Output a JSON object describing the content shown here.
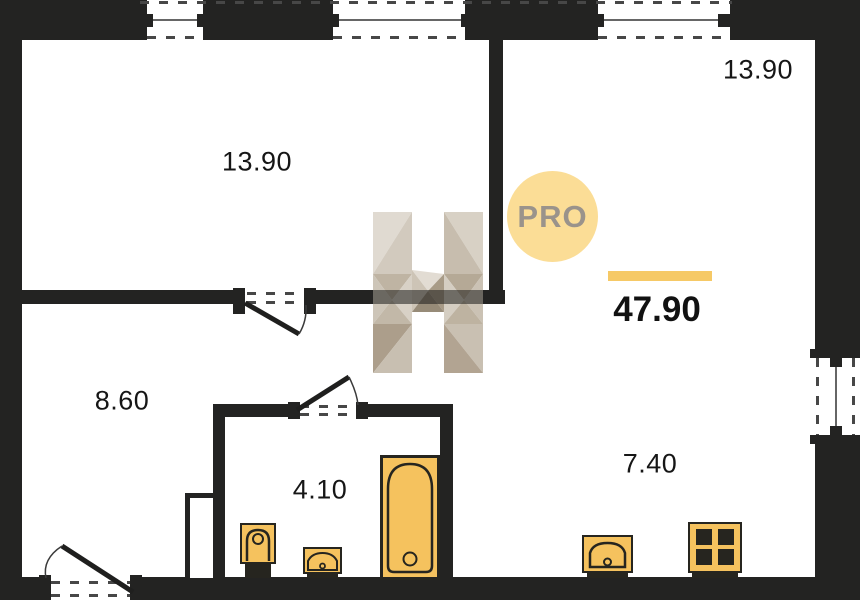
{
  "badge": {
    "label": "PRO"
  },
  "summary": {
    "total_area": "47.90"
  },
  "rooms": {
    "top_left_room": {
      "area": "13.90"
    },
    "top_right_room": {
      "area": "13.90"
    },
    "hallway": {
      "area": "8.60"
    },
    "bathroom": {
      "area": "4.10"
    },
    "kitchen_living": {
      "area": "7.40"
    }
  },
  "colors": {
    "wall": "#232322",
    "accent_yellow": "#F6C966",
    "fixture_yellow": "#F5C25E",
    "fixture_outline": "#26251F",
    "badge_bg": "#FBDD96",
    "badge_text": "#9A938B",
    "text": "#161616"
  }
}
